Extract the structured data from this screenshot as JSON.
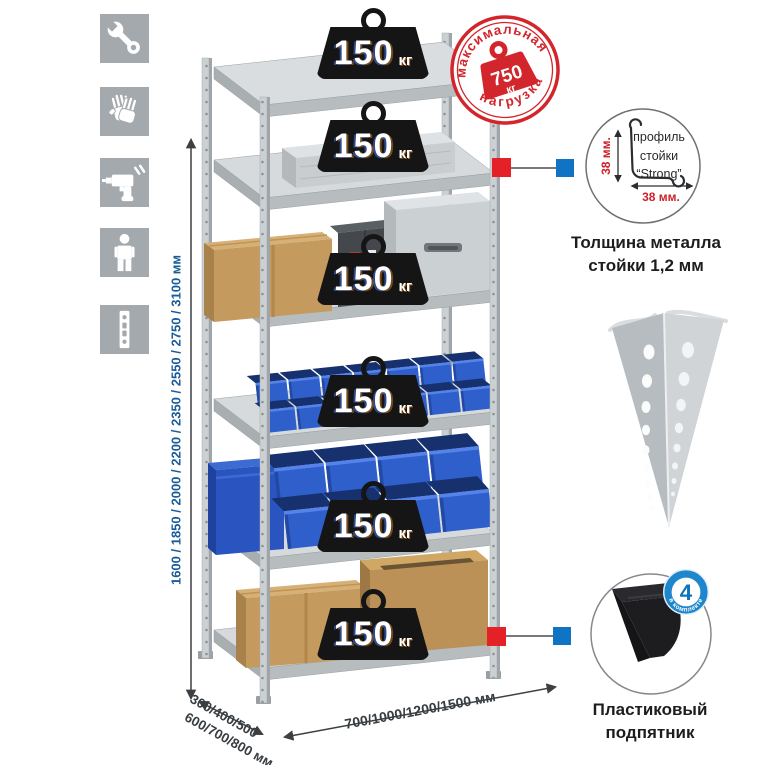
{
  "canvas": {
    "width": 765,
    "height": 765,
    "background": "#ffffff"
  },
  "sidebar": {
    "icons": [
      {
        "name": "wrench"
      },
      {
        "name": "gloves"
      },
      {
        "name": "drill"
      },
      {
        "name": "person"
      },
      {
        "name": "perforated-profile"
      }
    ]
  },
  "dimensions": {
    "height": "1600 / 1850 / 2000 / 2200 / 2350 / 2550 / 2750 / 3100 мм",
    "depth_line1": "300/400/500",
    "depth_line2": "600/700/800 мм",
    "width": "700/1000/1200/1500 мм"
  },
  "shelf_loads": [
    {
      "value": "150",
      "unit": "кг"
    },
    {
      "value": "150",
      "unit": "кг"
    },
    {
      "value": "150",
      "unit": "кг"
    },
    {
      "value": "150",
      "unit": "кг"
    },
    {
      "value": "150",
      "unit": "кг"
    },
    {
      "value": "150",
      "unit": "кг"
    }
  ],
  "stamp": {
    "arc_top": "максимальная",
    "arc_bottom": "нагрузка",
    "value": "750",
    "unit": "кг"
  },
  "profile_callout": {
    "line1": "профиль",
    "line2": "стойки",
    "line3": "“Strong”",
    "dim_vertical": "38 мм.",
    "dim_horizontal": "38 мм.",
    "caption1": "Толщина металла",
    "caption2": "стойки 1,2 мм"
  },
  "foot_callout": {
    "badge_value": "4",
    "badge_arc": "в комплекте",
    "caption1": "Пластиковый",
    "caption2": "подпятник"
  },
  "colors": {
    "icon_bg": "#a4a9ad",
    "dimension_text_blue": "#1a5c99",
    "stamp_red": "#d2262c",
    "callout_red": "#e42127",
    "callout_blue": "#1173c4",
    "bin_blue": "#2e5fca",
    "weight_black": "#151515",
    "badge_blue": "#1e86cc"
  }
}
